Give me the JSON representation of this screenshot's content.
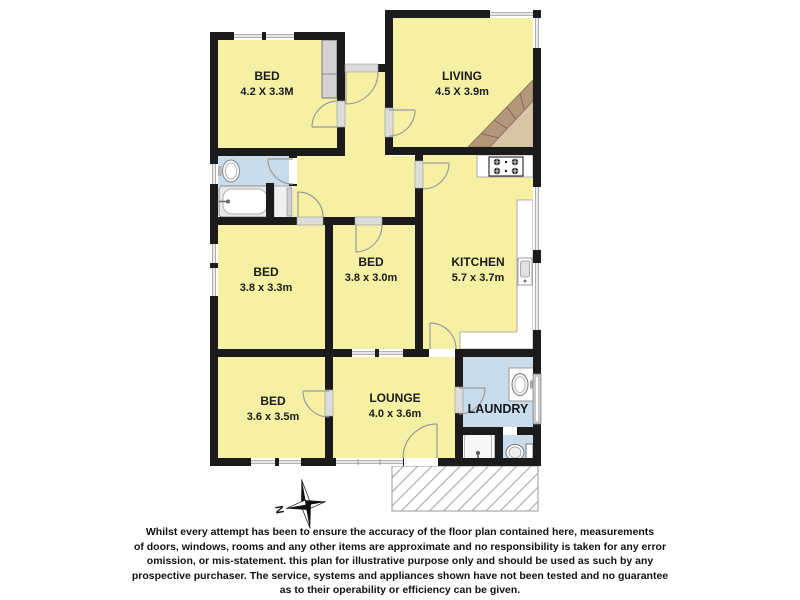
{
  "page": {
    "type": "real-estate floor plan"
  },
  "rooms": [
    {
      "id": "bed1",
      "name": "BED",
      "dims": "4.2 X 3.3M"
    },
    {
      "id": "living",
      "name": "LIVING",
      "dims": "4.5 X 3.9m"
    },
    {
      "id": "bed2",
      "name": "BED",
      "dims": "3.8 x 3.3m"
    },
    {
      "id": "bed3",
      "name": "BED",
      "dims": "3.8 x 3.0m"
    },
    {
      "id": "kitchen",
      "name": "KITCHEN",
      "dims": "5.7 x 3.7m"
    },
    {
      "id": "bed4",
      "name": "BED",
      "dims": "3.6 x 3.5m"
    },
    {
      "id": "lounge",
      "name": "LOUNGE",
      "dims": "4.0 x 3.6m"
    },
    {
      "id": "laundry",
      "name": "LAUNDRY",
      "dims": ""
    }
  ],
  "fixtures": [
    "bathtub",
    "basin",
    "linen-cupboard",
    "wardrobe",
    "cooktop",
    "kitchen-sink",
    "kitchen-bench",
    "laundry-trough",
    "laundry-basin",
    "toilet",
    "sliding-door",
    "deck"
  ],
  "compass": {
    "north_label": "N"
  },
  "disclaimer": {
    "lines": [
      "Whilst every attempt has been to ensure the accuracy of the floor plan contained here, measurements",
      "of doors, windows, rooms and any other items are approximate and no responsibility is taken for any error",
      "omission, or mis-statement. this plan for illustrative purpose only and should be used as such by any",
      "prospective purchaser. The service, systems and appliances shown have not been tested and no guarantee",
      "as to their operability or efficiency can be given."
    ]
  },
  "colors": {
    "room_fill": "#f6f0a4",
    "wet_area_fill": "#c9dcec",
    "wall": "#1b1b1b",
    "stair_dark": "#b3977a",
    "stair_light": "#d8c5a5",
    "hatch_line": "#adadad"
  }
}
